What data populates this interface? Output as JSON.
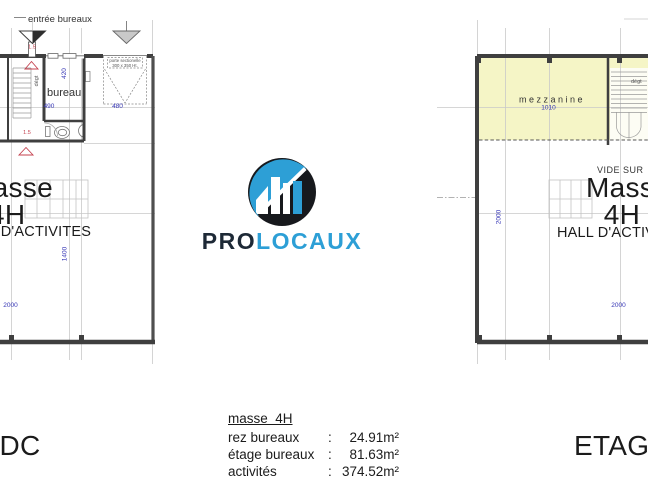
{
  "colors": {
    "mezzanine": "#f5f5c6",
    "dim_blue": "#3535b5",
    "red_mark": "#c4404e",
    "wall": "#3f3f3f",
    "logo_blue": "#2d9fd6",
    "logo_dark": "#17191d"
  },
  "logo": {
    "text_pro": "PRO",
    "text_locaux": "LOCAUX"
  },
  "rdc": {
    "entrance_label": "entrée bureaux",
    "bureau_label": "bureau",
    "degt_label": "dégt",
    "door_line1": "porte sectionelle",
    "door_line2": "300 x 350 Ht.",
    "dim_420": "420",
    "dim_490": "490",
    "dim_480": "480",
    "dim_1400": "1400",
    "dim_2000": "2000",
    "red_mark_top": "1.5",
    "red_mark_wc": "1.5",
    "masse": "Masse",
    "masse2": "4H",
    "hall": "HALL D'ACTIVITES",
    "floor_label": "RDC"
  },
  "etage": {
    "mezzanine_label": "mezzanine",
    "dim_1010": "1010",
    "dim_2000_left": "2000",
    "dim_2000_bottom": "2000",
    "degt_label": "dégt",
    "vide_label": "VIDE SUR",
    "masse": "Masse",
    "masse2": "4H",
    "hall": "HALL D'ACTIVITES",
    "floor_label": "ETAGE"
  },
  "summary": {
    "title": "masse  4H",
    "rows": [
      {
        "label": "rez bureaux",
        "sep": ":",
        "value": "24.91m²"
      },
      {
        "label": "étage bureaux",
        "sep": ":",
        "value": "81.63m²"
      },
      {
        "label": "activités",
        "sep": ":",
        "value": "374.52m²"
      }
    ]
  }
}
